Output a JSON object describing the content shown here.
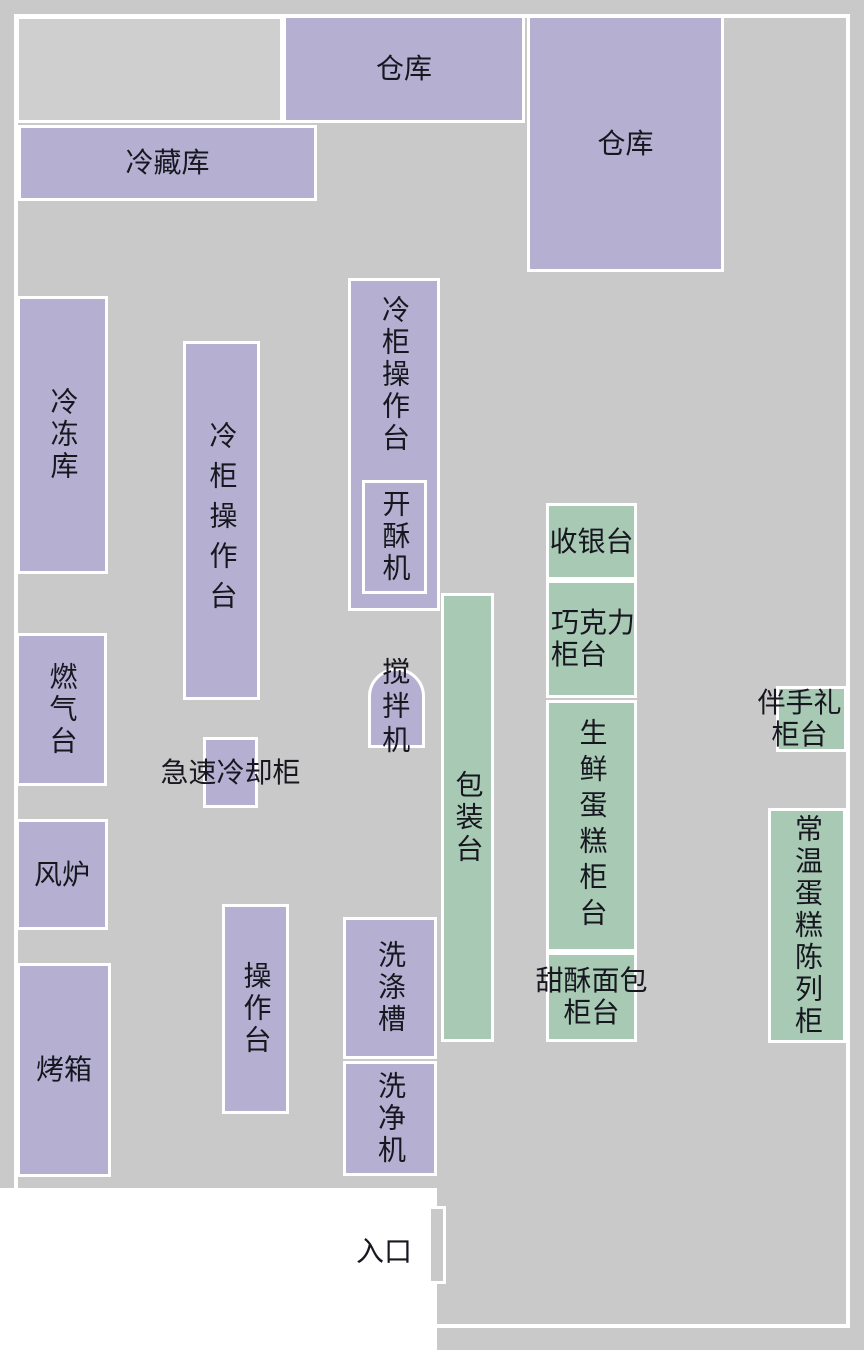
{
  "diagram": {
    "type": "floor_plan",
    "colors": {
      "floor": "#c9c9c9",
      "equipment_zone": "#b5b0d2",
      "retail_zone": "#a8c9b4",
      "wall_line": "#ffffff",
      "label_text": "#17171f",
      "unlabeled_room": "#cfcfcf"
    }
  },
  "rooms": {
    "warehouse_top": "仓库",
    "warehouse_right": "仓库",
    "cold_storage": "冷藏库",
    "freezer": "冷冻库",
    "cold_counter_left": "冷柜操作台",
    "cold_counter_mid": "冷柜操作台",
    "dough_sheeter": "开酥机",
    "gas_stove": "燃气台",
    "rapid_cooling": "急速冷却柜",
    "mixer": "搅拌机",
    "convection_oven": "风炉",
    "oven": "烤箱",
    "work_counter": "操作台",
    "washing_sink": "洗涤槽",
    "washer": "洗净机",
    "packing_counter": "包装台",
    "cashier": "收银台",
    "chocolate_counter": "巧克力\n柜台",
    "fresh_cake_counter": "生鲜蛋糕柜台",
    "sweet_bread_counter": "甜酥面包\n柜台",
    "gift_counter": "伴手礼\n柜台",
    "ambient_cake_display": "常温蛋糕陈列柜",
    "entrance": "入口"
  }
}
